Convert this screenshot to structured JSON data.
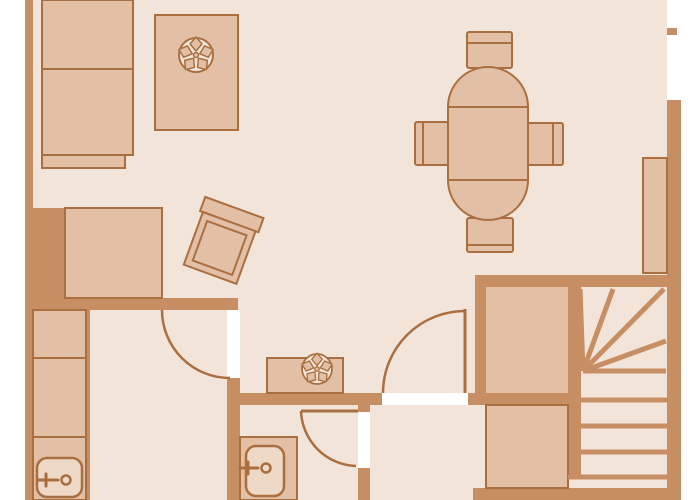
{
  "app": {
    "type": "architectural-floor-plan",
    "visible_text": "none"
  },
  "colors": {
    "background": "#ffffff",
    "floor": "#f3e4d9",
    "wall": "#c78e64",
    "line": "#a96f41",
    "furn": "#e3c0a5",
    "sinkfill": "#eed9c6"
  },
  "plan": {
    "canvas": {
      "width": 700,
      "height": 500
    },
    "walls": [
      {
        "name": "wall-left",
        "x": 25,
        "y": 0,
        "w": 8,
        "h": 500
      },
      {
        "name": "wall-left-block",
        "x": 33,
        "y": 208,
        "w": 32,
        "h": 90
      },
      {
        "name": "wall-horizontal-a",
        "x": 25,
        "y": 298,
        "w": 213,
        "h": 12
      },
      {
        "name": "wall-vertical-b",
        "x": 227,
        "y": 378,
        "w": 13,
        "h": 122
      },
      {
        "name": "wall-thin-c",
        "x": 85,
        "y": 310,
        "w": 5,
        "h": 190
      },
      {
        "name": "wall-horizontal-d",
        "x": 228,
        "y": 393,
        "w": 353,
        "h": 12
      },
      {
        "name": "wall-vertical-e-top",
        "x": 358,
        "y": 405,
        "w": 12,
        "h": 7
      },
      {
        "name": "wall-vertical-e-bottom",
        "x": 358,
        "y": 468,
        "w": 12,
        "h": 32
      },
      {
        "name": "wall-stairs-top",
        "x": 475,
        "y": 275,
        "w": 206,
        "h": 12
      },
      {
        "name": "wall-stairs-left",
        "x": 475,
        "y": 287,
        "w": 11,
        "h": 106
      },
      {
        "name": "wall-stairs-divider",
        "x": 568,
        "y": 287,
        "w": 13,
        "h": 190
      },
      {
        "name": "wall-right",
        "x": 667,
        "y": 100,
        "w": 14,
        "h": 400
      },
      {
        "name": "wall-window-stub",
        "x": 667,
        "y": 28,
        "w": 10,
        "h": 7
      },
      {
        "name": "wall-bottom",
        "x": 473,
        "y": 488,
        "w": 208,
        "h": 12
      }
    ],
    "door_openings": [
      {
        "name": "door-opening-bedroom",
        "x": 227,
        "y": 310,
        "w": 13,
        "h": 68
      },
      {
        "name": "door-opening-hall",
        "x": 382,
        "y": 393,
        "w": 86,
        "h": 12
      },
      {
        "name": "door-opening-bathroom",
        "x": 358,
        "y": 412,
        "w": 12,
        "h": 56
      }
    ],
    "stairs": {
      "winder_apex": [
        583,
        371
      ],
      "winder_rays": [
        [
          580,
          289
        ],
        [
          613,
          289
        ],
        [
          664,
          289
        ],
        [
          666,
          341
        ],
        [
          666,
          371
        ]
      ],
      "tread_lines_y": [
        400,
        426,
        452,
        477
      ],
      "upper_landing": {
        "x": 486,
        "y": 287,
        "w": 82,
        "h": 106
      },
      "lower_landing": {
        "x": 486,
        "y": 405,
        "w": 82,
        "h": 83
      }
    },
    "furniture": [
      {
        "name": "kitchen-cabinet-upper",
        "x": 42,
        "y": 0,
        "w": 91,
        "h": 69
      },
      {
        "name": "kitchen-cabinet-lower",
        "x": 42,
        "y": 69,
        "w": 91,
        "h": 86
      },
      {
        "name": "kitchen-counter-step",
        "x": 42,
        "y": 155,
        "w": 83,
        "h": 13
      },
      {
        "name": "plant-table-1",
        "x": 155,
        "y": 15,
        "w": 83,
        "h": 115
      },
      {
        "name": "plant-1",
        "cx": 196,
        "cy": 55,
        "r": 17
      },
      {
        "name": "sofa",
        "x": 65,
        "y": 208,
        "w": 97,
        "h": 90
      },
      {
        "name": "armchair",
        "cx": 220,
        "cy": 247,
        "rotation_deg": 20
      },
      {
        "name": "dining-table",
        "x": 448,
        "y": 67,
        "w": 80,
        "h": 153,
        "rx": 40
      },
      {
        "name": "dining-chair-north",
        "x": 467,
        "y": 32,
        "w": 45,
        "h": 36
      },
      {
        "name": "dining-chair-west",
        "x": 415,
        "y": 122,
        "w": 33,
        "h": 43
      },
      {
        "name": "dining-chair-east",
        "x": 528,
        "y": 123,
        "w": 35,
        "h": 42
      },
      {
        "name": "dining-chair-south",
        "x": 467,
        "y": 218,
        "w": 46,
        "h": 34
      },
      {
        "name": "wall-shelf-east",
        "x": 643,
        "y": 158,
        "w": 24,
        "h": 115
      },
      {
        "name": "closet-cabinet-1",
        "x": 33,
        "y": 310,
        "w": 53,
        "h": 48
      },
      {
        "name": "closet-cabinet-2",
        "x": 33,
        "y": 358,
        "w": 53,
        "h": 79
      },
      {
        "name": "closet-counter",
        "x": 33,
        "y": 437,
        "w": 53,
        "h": 63
      },
      {
        "name": "washbasin-1",
        "x": 37,
        "y": 458,
        "w": 45,
        "h": 39
      },
      {
        "name": "bathroom-counter",
        "x": 240,
        "y": 437,
        "w": 57,
        "h": 63
      },
      {
        "name": "washbasin-2",
        "x": 246,
        "y": 446,
        "w": 38,
        "h": 50
      },
      {
        "name": "plant-table-2",
        "x": 267,
        "y": 358,
        "w": 76,
        "h": 35
      },
      {
        "name": "plant-2",
        "cx": 317,
        "cy": 369,
        "r": 15
      }
    ],
    "doors": [
      {
        "name": "door-bedroom",
        "hinge": [
          230,
          310
        ],
        "radius": 68
      },
      {
        "name": "door-hall",
        "hinge": [
          465,
          393
        ],
        "radius": 82
      },
      {
        "name": "door-bathroom",
        "hinge": [
          358,
          411
        ],
        "radius": 57
      }
    ]
  }
}
